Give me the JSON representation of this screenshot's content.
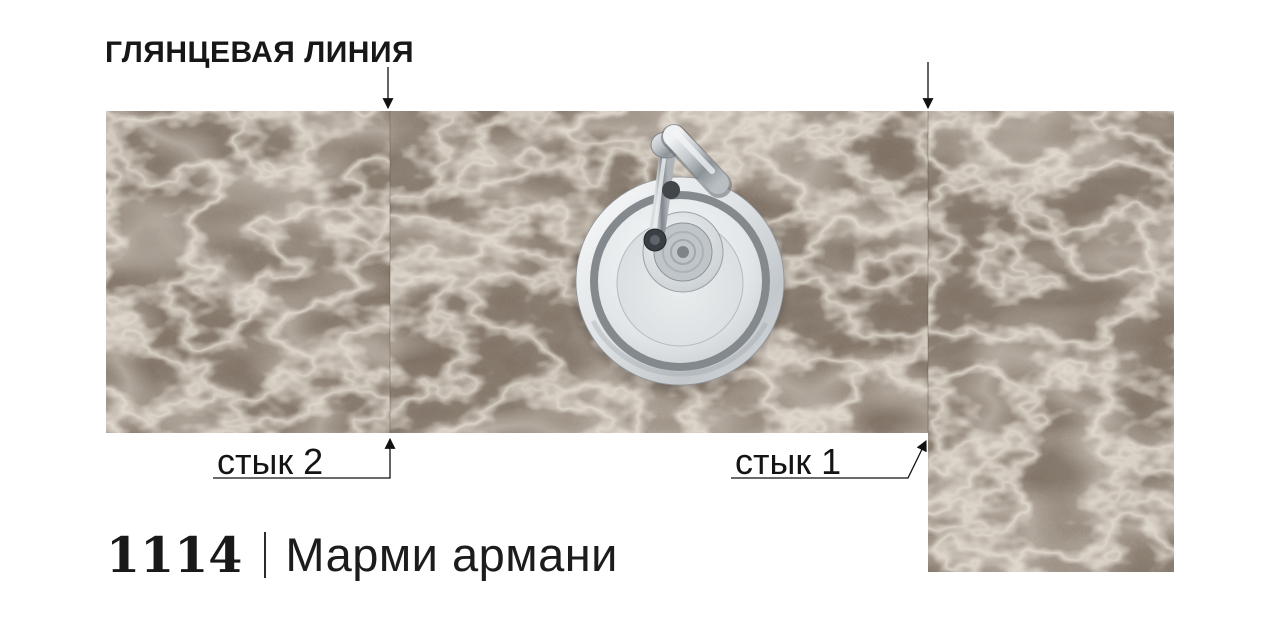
{
  "diagram": {
    "glossy_line_label": "ГЛЯНЦЕВАЯ ЛИНИЯ",
    "joint_2_label": "стык 2",
    "joint_1_label": "стык 1"
  },
  "product": {
    "code": "1114",
    "name": "Марми армани"
  },
  "graphic": {
    "description": "L-shaped brown marble worktop, top view, round stainless-steel sink with chrome mixer tap, two panel joints marked with arrows",
    "colors": {
      "marble_base": "#7c6e61",
      "marble_vein": "#d9cfc1",
      "annotation": "#111111",
      "steel_light": "#eef1f2",
      "steel_dark": "#84898e"
    }
  }
}
